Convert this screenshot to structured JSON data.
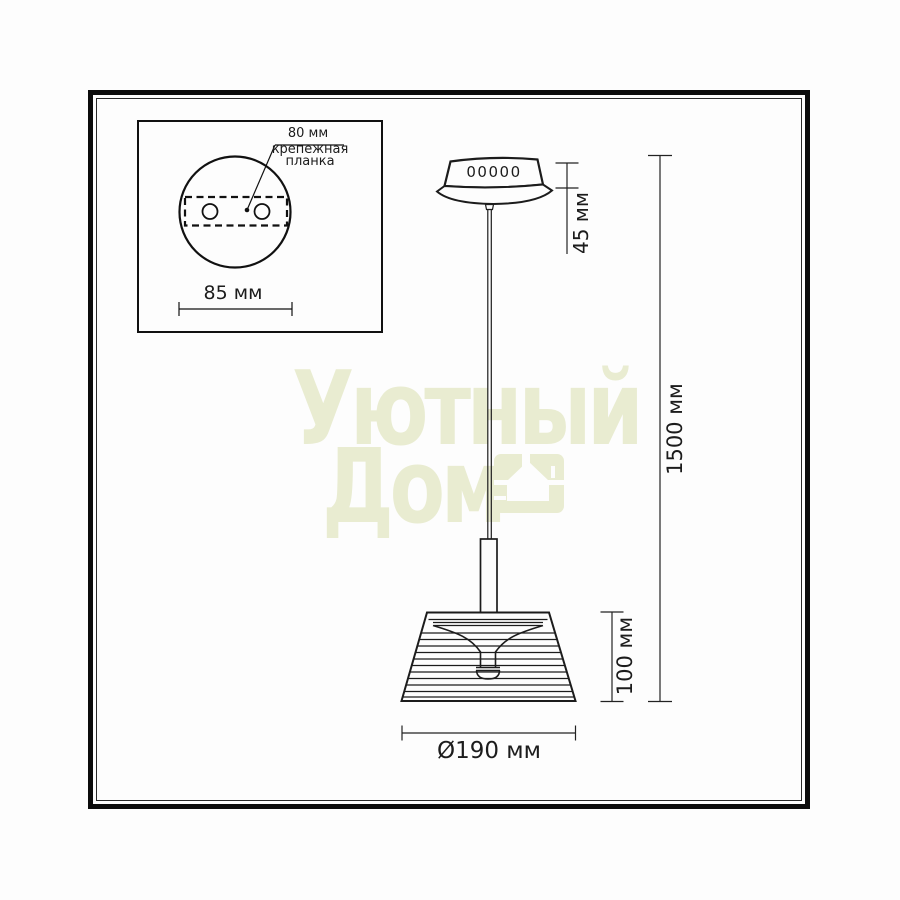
{
  "inset": {
    "plate_width_label": "80 мм",
    "plate_name_line1": "крепежная",
    "plate_name_line2": "планка",
    "plate_diameter_label": "85 мм"
  },
  "lamp": {
    "canopy_marking": "00000"
  },
  "dimensions": {
    "canopy_height": "45 мм",
    "cord_length": "1500 мм",
    "shade_height": "100 мм",
    "shade_diameter": "Ø190 мм"
  },
  "watermark": {
    "word1": "Уютный",
    "word2": "Дом"
  },
  "colors": {
    "line": "#1c1c1c",
    "watermark": "#e9ecd1"
  }
}
